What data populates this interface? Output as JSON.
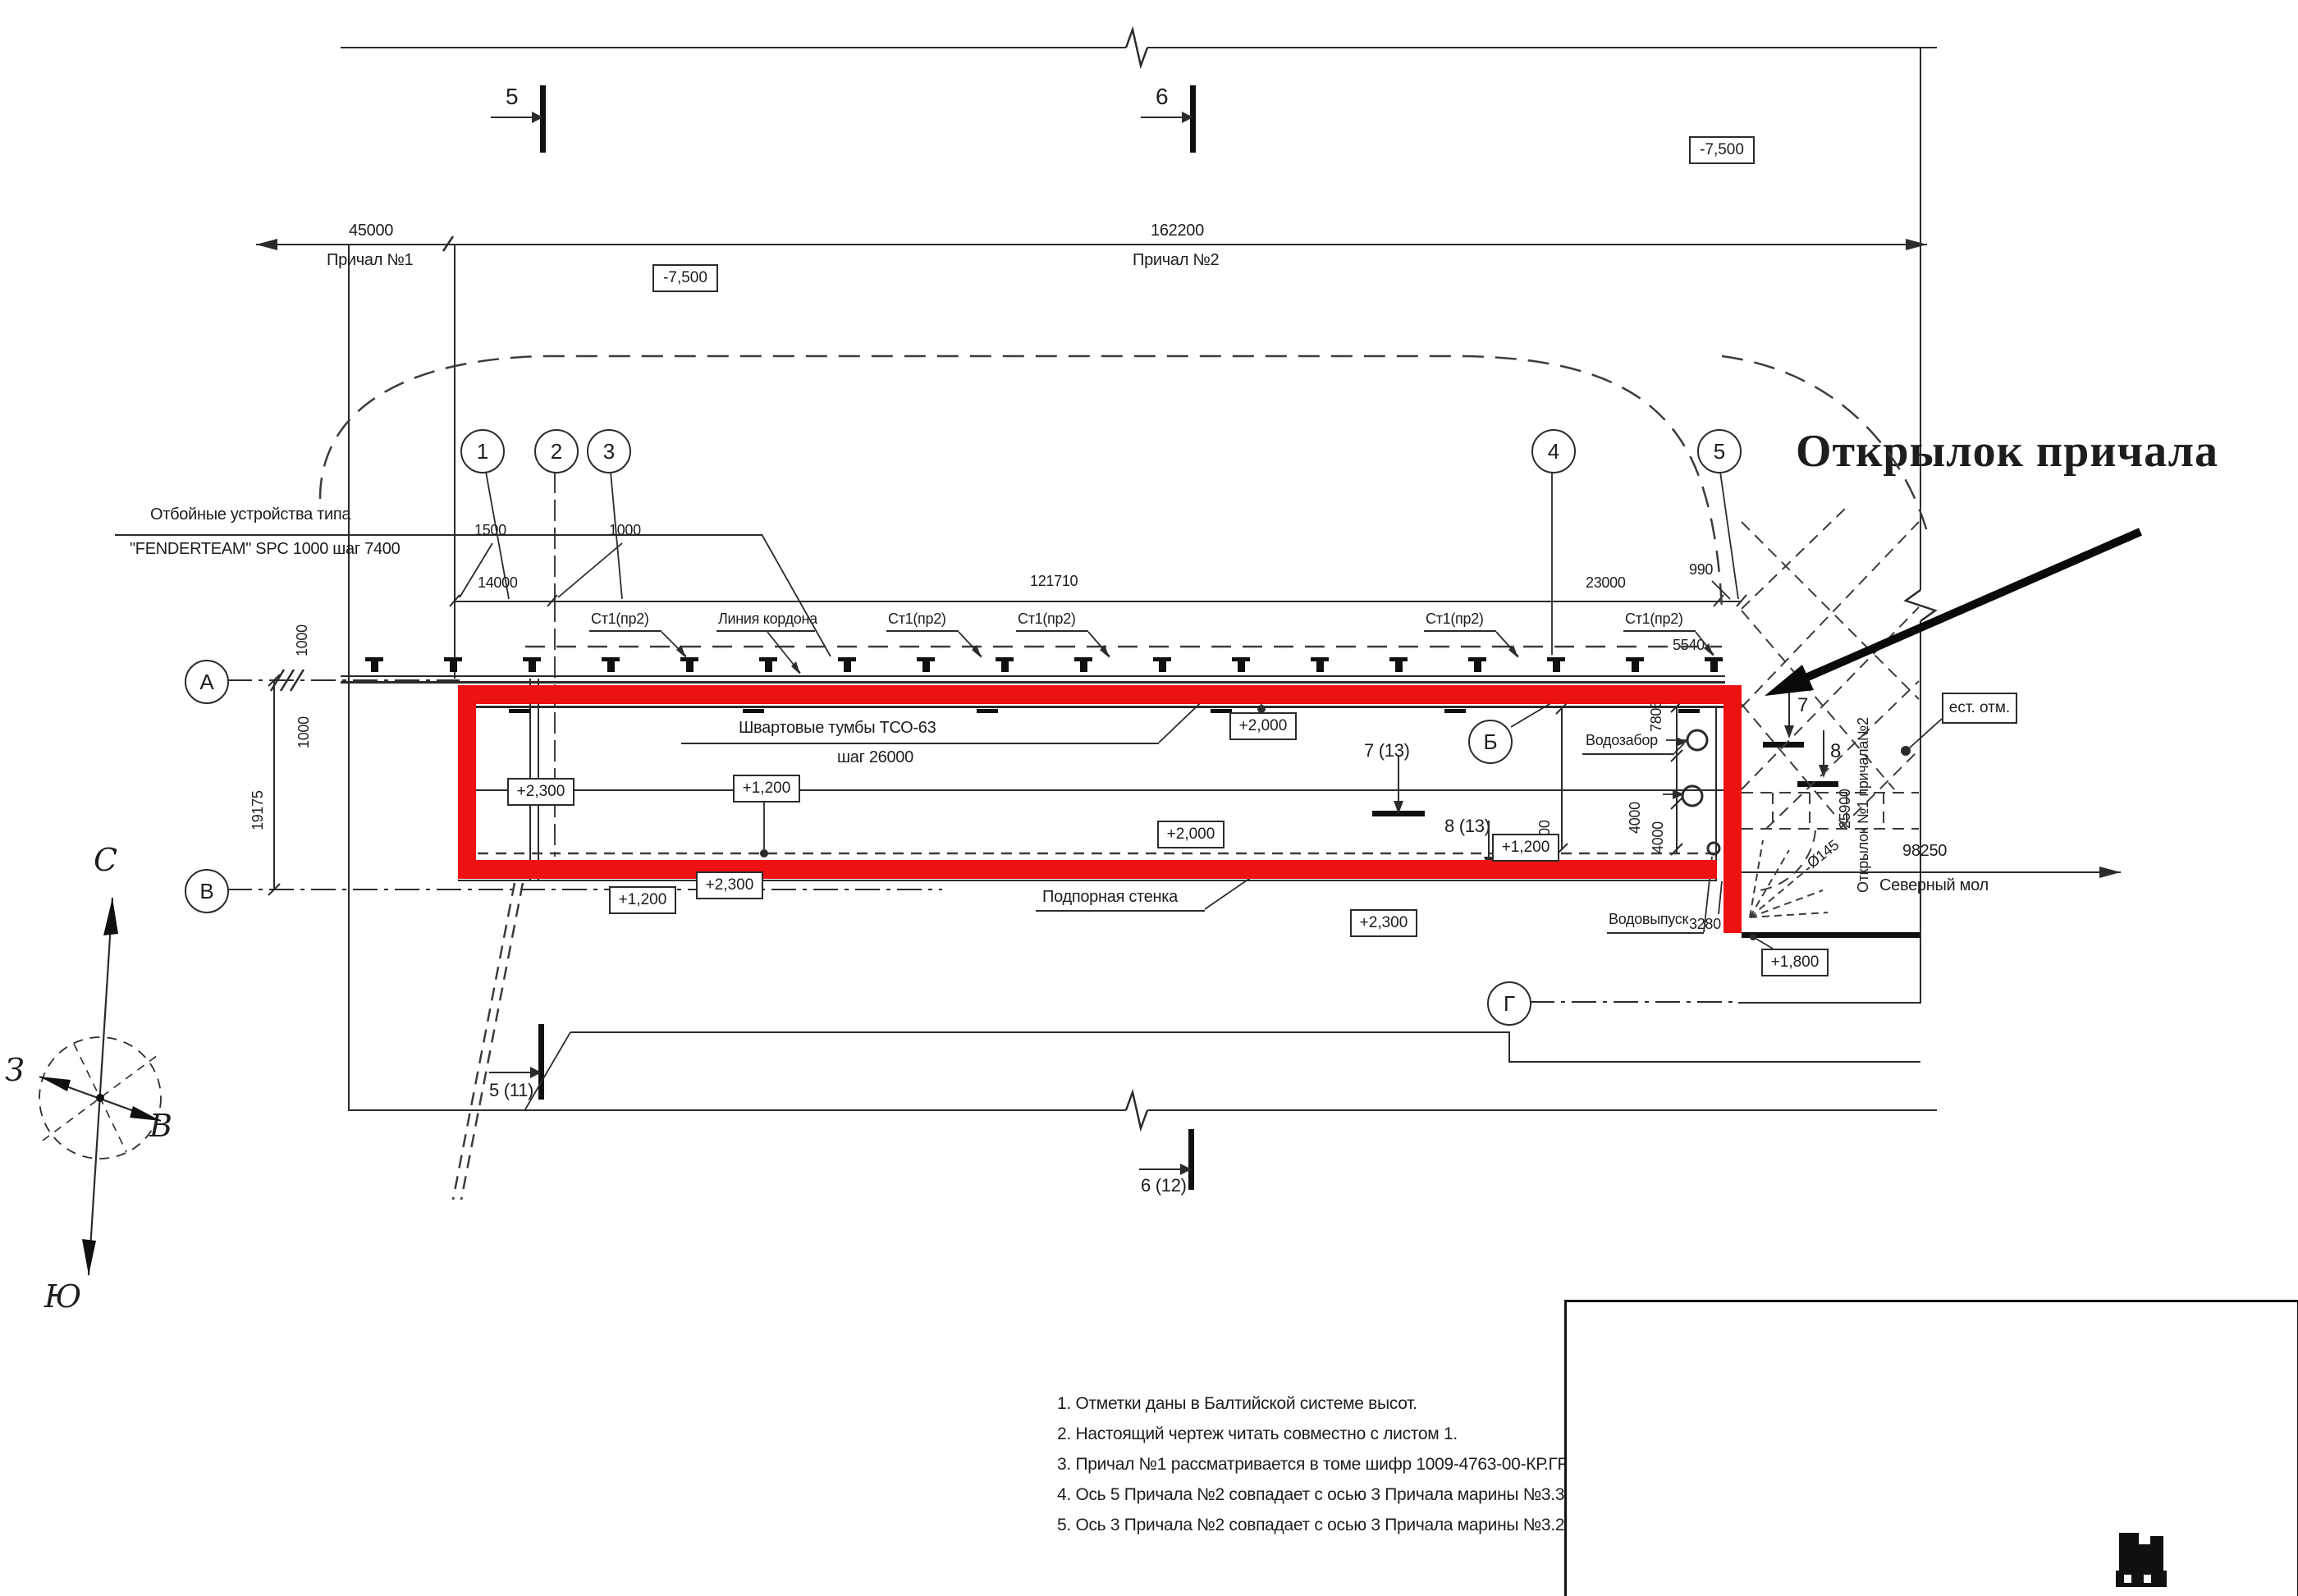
{
  "callout": {
    "text": "Открылок причала"
  },
  "colors": {
    "highlight": "#ee1111",
    "line": "#2b2b2b",
    "signature": "#2437b8"
  },
  "top_dims": {
    "d45000": "45000",
    "berth1": "Причал №1",
    "d162200": "162200",
    "berth2": "Причал №2"
  },
  "elevations": {
    "e_m75": "-7,500",
    "e23": "+2,300",
    "e12": "+1,200",
    "e20": "+2,000",
    "e18": "+1,800"
  },
  "sections": {
    "s5": "5",
    "s6": "6",
    "s511": "5 (11)",
    "s612": "6 (12)",
    "s713": "7 (13)",
    "s813": "8 (13)",
    "s7": "7",
    "s8": "8"
  },
  "axes": {
    "n1": "1",
    "n2": "2",
    "n3": "3",
    "n4": "4",
    "n5": "5",
    "A": "А",
    "B": "Б",
    "V": "В",
    "G": "Г"
  },
  "dims": {
    "d1500": "1500",
    "d1000": "1000",
    "d14000": "14000",
    "d121710": "121710",
    "d23000": "23000",
    "d990": "990",
    "d5540": "5540",
    "d19175": "19175",
    "d7805": "7805",
    "d4000": "4000",
    "d22000": "22000",
    "d3280": "3280",
    "d25900": "25900",
    "d98250": "98250"
  },
  "labels": {
    "fender1": "Отбойные устройства типа",
    "fender2": "\"FENDERTEAM\" SPC 1000 шаг 7400",
    "st1": "Ст1(пр2)",
    "cordon": "Линия кордона",
    "bollards1": "Швартовые тумбы ТСО-63",
    "bollards2": "шаг 26000",
    "retaining": "Подпорная стенка",
    "intake": "Водозабор",
    "outlet": "Водовыпуск",
    "nat_mark": "ест. отм.",
    "wing_axis": "Открылок №1 причала№2",
    "mole": "Северный мол",
    "dia": "Ø145"
  },
  "compass": {
    "n": "С",
    "w": "З",
    "e": "В",
    "s": "Ю"
  },
  "notes": [
    "1. Отметки даны в Балтийской системе высот.",
    "2. Настоящий чертеж читать совместно с листом 1.",
    "3. Причал №1 рассматривается в томе шифр 1009-4763-00-КР.ГР2.1-4.2.1.",
    "4. Ось 5 Причала №2 совпадает с осью 3 Причала марины №3.3.",
    "5. Ось 3 Причала №2 совпадает с осью 3 Причала марины №3.2."
  ],
  "title_block": {
    "code": "1009-4763-00-КР.ГР1.1-4.1.1",
    "project1": "Комплекс береговой и морской инфраструктуры",
    "project2": "в морском порту Геленджик",
    "object1": "Объекты государственной",
    "object2": "федеральной собственности",
    "sheet_title1": "Причал №2.",
    "sheet_title2": "План",
    "stage_label": "Стадия",
    "sheet_label": "Лист",
    "sheets_label": "Листов",
    "stage": "П",
    "sheet": "3",
    "company": "ООО \"ПромПроект\"",
    "rev_row": {
      "izm": "12",
      "kol": "-",
      "list": "Зам.",
      "doc": "019-23",
      "date": "03.2023"
    },
    "head": {
      "izm": "Изм.",
      "kol": "Кол.уч.",
      "list": "Лист",
      "doc": "№ док.",
      "sign": "Подпись",
      "date": "Дата"
    },
    "rows": [
      {
        "role": "Разраб.",
        "name": "Колюкова",
        "date": "03.2023"
      },
      {
        "role": "Пров.",
        "name": "Вашпанов",
        "date": "03.2023"
      },
      {
        "role": "Н. контр.",
        "name": "Бахвалова",
        "date": "03.2023"
      },
      {
        "role": "ГИП",
        "name": "Корелов",
        "date": "03.2023"
      }
    ]
  }
}
